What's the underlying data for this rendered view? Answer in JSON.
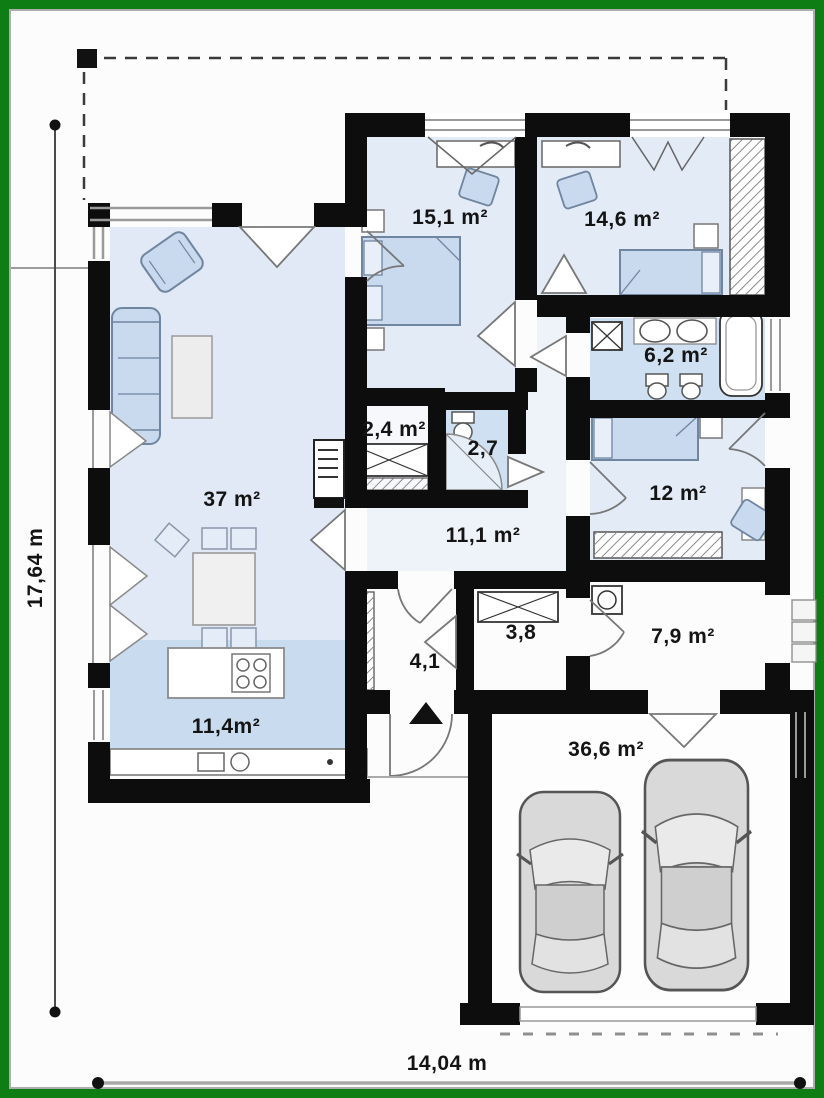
{
  "title": "single-storey house floor plan with double garage",
  "colors": {
    "frame_green": "#0e7d13",
    "paper": "#fcfcfd",
    "wall_black": "#0d0d0d",
    "room_blue_light": "#e3ebf6",
    "room_blue_medium": "#cfe0f2",
    "kitchen_blue": "#c9dbee",
    "corridor_blue": "#eef3fa",
    "furniture_blue": "#c9d9ee",
    "car_gray": "#d9d9d9"
  },
  "rooms": {
    "living": {
      "label": "37 m²"
    },
    "kitchen": {
      "label": "11,4m²"
    },
    "bedroom1": {
      "label": "15,1 m²"
    },
    "bedroom2": {
      "label": "14,6 m²"
    },
    "bathroom": {
      "label": "6,2 m²"
    },
    "closet": {
      "label": "2,4 m²"
    },
    "wc": {
      "label": "2,7"
    },
    "corridor": {
      "label": "11,1 m²"
    },
    "bedroom3": {
      "label": "12 m²"
    },
    "utility": {
      "label": "7,9 m²"
    },
    "storage": {
      "label": "3,8"
    },
    "hall": {
      "label": "4,1"
    },
    "garage": {
      "label": "36,6 m²"
    }
  },
  "dimensions": {
    "height_label": "17,64 m",
    "width_label": "14,04 m"
  }
}
